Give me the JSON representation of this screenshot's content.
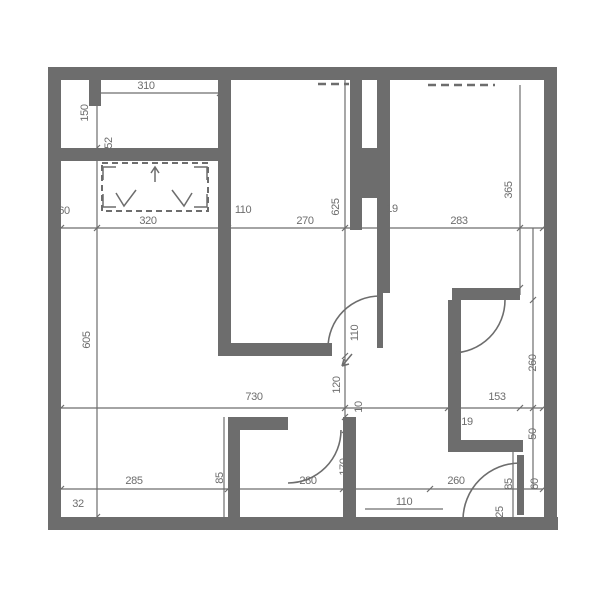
{
  "colors": {
    "wall": "#6d6d6d",
    "dim": "#6d6d6d",
    "background": "#ffffff"
  },
  "floorplan": {
    "walls": [
      {
        "x": 48,
        "y": 67,
        "w": 509,
        "h": 13
      },
      {
        "x": 48,
        "y": 67,
        "w": 13,
        "h": 463
      },
      {
        "x": 48,
        "y": 517,
        "w": 510,
        "h": 13
      },
      {
        "x": 544,
        "y": 67,
        "w": 13,
        "h": 463
      },
      {
        "x": 61,
        "y": 148,
        "w": 159,
        "h": 13
      },
      {
        "x": 89,
        "y": 78,
        "w": 12,
        "h": 28
      },
      {
        "x": 218,
        "y": 80,
        "w": 13,
        "h": 276
      },
      {
        "x": 225,
        "y": 343,
        "w": 107,
        "h": 13
      },
      {
        "x": 377,
        "y": 80,
        "w": 13,
        "h": 213
      },
      {
        "x": 377,
        "y": 293,
        "w": 6,
        "h": 55
      },
      {
        "x": 350,
        "y": 80,
        "w": 12,
        "h": 150
      },
      {
        "x": 362,
        "y": 148,
        "w": 18,
        "h": 50
      },
      {
        "x": 452,
        "y": 288,
        "w": 68,
        "h": 12
      },
      {
        "x": 448,
        "y": 300,
        "w": 13,
        "h": 152
      },
      {
        "x": 448,
        "y": 440,
        "w": 75,
        "h": 12
      },
      {
        "x": 228,
        "y": 417,
        "w": 12,
        "h": 100
      },
      {
        "x": 240,
        "y": 417,
        "w": 48,
        "h": 13
      },
      {
        "x": 343,
        "y": 417,
        "w": 13,
        "h": 100
      },
      {
        "x": 517,
        "y": 455,
        "w": 7,
        "h": 60
      }
    ],
    "door_arcs": [
      "M 328,348 A 52 52 0 0 1 380,296",
      "M 452,353 A 53 53 0 0 0 505,300",
      "M 341,430 A 53 53 0 0 1 288,483",
      "M 463,520 A 57 57 0 0 1 520,463"
    ],
    "dashed_lines": [
      {
        "x1": 318,
        "y1": 84,
        "x2": 349,
        "y2": 84
      },
      {
        "x1": 428,
        "y1": 85,
        "x2": 495,
        "y2": 85
      }
    ],
    "wardrobe": {
      "x": 102,
      "y": 163,
      "w": 106,
      "h": 48
    },
    "symbol_lines": [
      "M 103,180 L 103,167 L 116,167",
      "M 207,180 L 207,167 L 194,167",
      "M 103,194 L 103,207 L 116,207",
      "M 207,194 L 207,207 L 194,207",
      "M 155,182 L 155,167 M 151,173 L 155,167 L 159,173",
      "M 116,193 L 124,206 L 136,190",
      "M 172,190 L 184,206 L 192,193",
      "M 352,354 L 342,366 M 342,366 L 344,359 M 342,366 L 349,364"
    ],
    "dim_lines": [
      {
        "x1": 97,
        "y1": 93,
        "x2": 220,
        "y2": 93
      },
      {
        "x1": 48,
        "y1": 228,
        "x2": 557,
        "y2": 228
      },
      {
        "x1": 61,
        "y1": 408,
        "x2": 543,
        "y2": 408
      },
      {
        "x1": 61,
        "y1": 489,
        "x2": 543,
        "y2": 489
      },
      {
        "x1": 365,
        "y1": 509,
        "x2": 443,
        "y2": 509
      },
      {
        "x1": 97,
        "y1": 80,
        "x2": 97,
        "y2": 517
      },
      {
        "x1": 345,
        "y1": 80,
        "x2": 345,
        "y2": 517
      },
      {
        "x1": 520,
        "y1": 85,
        "x2": 520,
        "y2": 295
      },
      {
        "x1": 533,
        "y1": 228,
        "x2": 533,
        "y2": 489
      },
      {
        "x1": 224,
        "y1": 417,
        "x2": 224,
        "y2": 517
      },
      {
        "x1": 513,
        "y1": 452,
        "x2": 513,
        "y2": 517
      }
    ],
    "ticks": [
      {
        "x": 97,
        "y": 93
      },
      {
        "x": 220,
        "y": 93
      },
      {
        "x": 61,
        "y": 228
      },
      {
        "x": 97,
        "y": 228
      },
      {
        "x": 228,
        "y": 228
      },
      {
        "x": 345,
        "y": 228
      },
      {
        "x": 383,
        "y": 228
      },
      {
        "x": 520,
        "y": 228
      },
      {
        "x": 543,
        "y": 228
      },
      {
        "x": 61,
        "y": 408
      },
      {
        "x": 345,
        "y": 408
      },
      {
        "x": 448,
        "y": 408
      },
      {
        "x": 520,
        "y": 408
      },
      {
        "x": 543,
        "y": 408
      },
      {
        "x": 61,
        "y": 489
      },
      {
        "x": 228,
        "y": 489
      },
      {
        "x": 343,
        "y": 489
      },
      {
        "x": 430,
        "y": 489
      },
      {
        "x": 543,
        "y": 489
      },
      {
        "x": 97,
        "y": 148
      },
      {
        "x": 97,
        "y": 517
      },
      {
        "x": 345,
        "y": 356
      },
      {
        "x": 345,
        "y": 417
      },
      {
        "x": 345,
        "y": 430
      },
      {
        "x": 345,
        "y": 517
      },
      {
        "x": 520,
        "y": 288
      },
      {
        "x": 533,
        "y": 300
      },
      {
        "x": 533,
        "y": 408
      }
    ],
    "labels": [
      {
        "text": "310",
        "x": 146,
        "y": 89,
        "rot": 0
      },
      {
        "text": "150",
        "x": 88,
        "y": 113,
        "rot": -90
      },
      {
        "text": "52",
        "x": 112,
        "y": 143,
        "rot": -90
      },
      {
        "text": "60",
        "x": 64,
        "y": 214,
        "rot": 0
      },
      {
        "text": "320",
        "x": 148,
        "y": 224,
        "rot": 0
      },
      {
        "text": "110",
        "x": 243,
        "y": 213,
        "rot": 0
      },
      {
        "text": "270",
        "x": 305,
        "y": 224,
        "rot": 0
      },
      {
        "text": "625",
        "x": 339,
        "y": 207,
        "rot": -90
      },
      {
        "text": "19",
        "x": 392,
        "y": 212,
        "rot": 0
      },
      {
        "text": "283",
        "x": 459,
        "y": 224,
        "rot": 0
      },
      {
        "text": "365",
        "x": 512,
        "y": 190,
        "rot": -90
      },
      {
        "text": "605",
        "x": 90,
        "y": 340,
        "rot": -90
      },
      {
        "text": "110",
        "x": 358,
        "y": 333,
        "rot": -90
      },
      {
        "text": "120",
        "x": 340,
        "y": 385,
        "rot": -90
      },
      {
        "text": "730",
        "x": 254,
        "y": 400,
        "rot": 0
      },
      {
        "text": "153",
        "x": 497,
        "y": 400,
        "rot": 0
      },
      {
        "text": "10",
        "x": 362,
        "y": 407,
        "rot": -90
      },
      {
        "text": "19",
        "x": 467,
        "y": 425,
        "rot": 0
      },
      {
        "text": "260",
        "x": 536,
        "y": 363,
        "rot": -90
      },
      {
        "text": "50",
        "x": 536,
        "y": 434,
        "rot": -90
      },
      {
        "text": "285",
        "x": 134,
        "y": 484,
        "rot": 0
      },
      {
        "text": "85",
        "x": 223,
        "y": 478,
        "rot": -90
      },
      {
        "text": "280",
        "x": 308,
        "y": 484,
        "rot": 0
      },
      {
        "text": "170",
        "x": 347,
        "y": 467,
        "rot": -90
      },
      {
        "text": "260",
        "x": 456,
        "y": 484,
        "rot": 0
      },
      {
        "text": "85",
        "x": 512,
        "y": 484,
        "rot": -90
      },
      {
        "text": "60",
        "x": 538,
        "y": 484,
        "rot": -90
      },
      {
        "text": "32",
        "x": 78,
        "y": 507,
        "rot": 0
      },
      {
        "text": "50",
        "x": 351,
        "y": 506,
        "rot": -90
      },
      {
        "text": "110",
        "x": 404,
        "y": 505,
        "rot": 0
      },
      {
        "text": "25",
        "x": 503,
        "y": 512,
        "rot": -90
      }
    ]
  }
}
